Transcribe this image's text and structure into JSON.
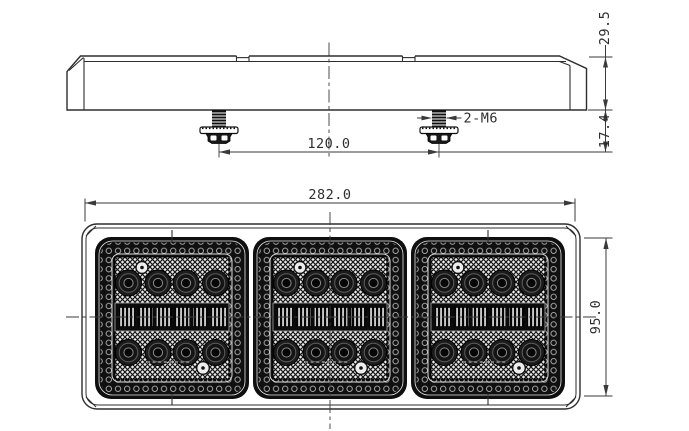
{
  "title": "LED rear combination lamp technical drawing",
  "views": {
    "side_view": "lamp side profile with mounting studs",
    "front_view": "lamp front face with three LED modules"
  },
  "dims": {
    "body_height": "29.5",
    "stud_length": "17.4",
    "thread_label": "2-M6",
    "bolt_spacing": "120.0",
    "overall_width": "282.0",
    "lens_height": "95.0"
  },
  "colors": {
    "line": "#2e2e2e",
    "module_dark": "#0f0f0f",
    "background": "#ffffff"
  }
}
